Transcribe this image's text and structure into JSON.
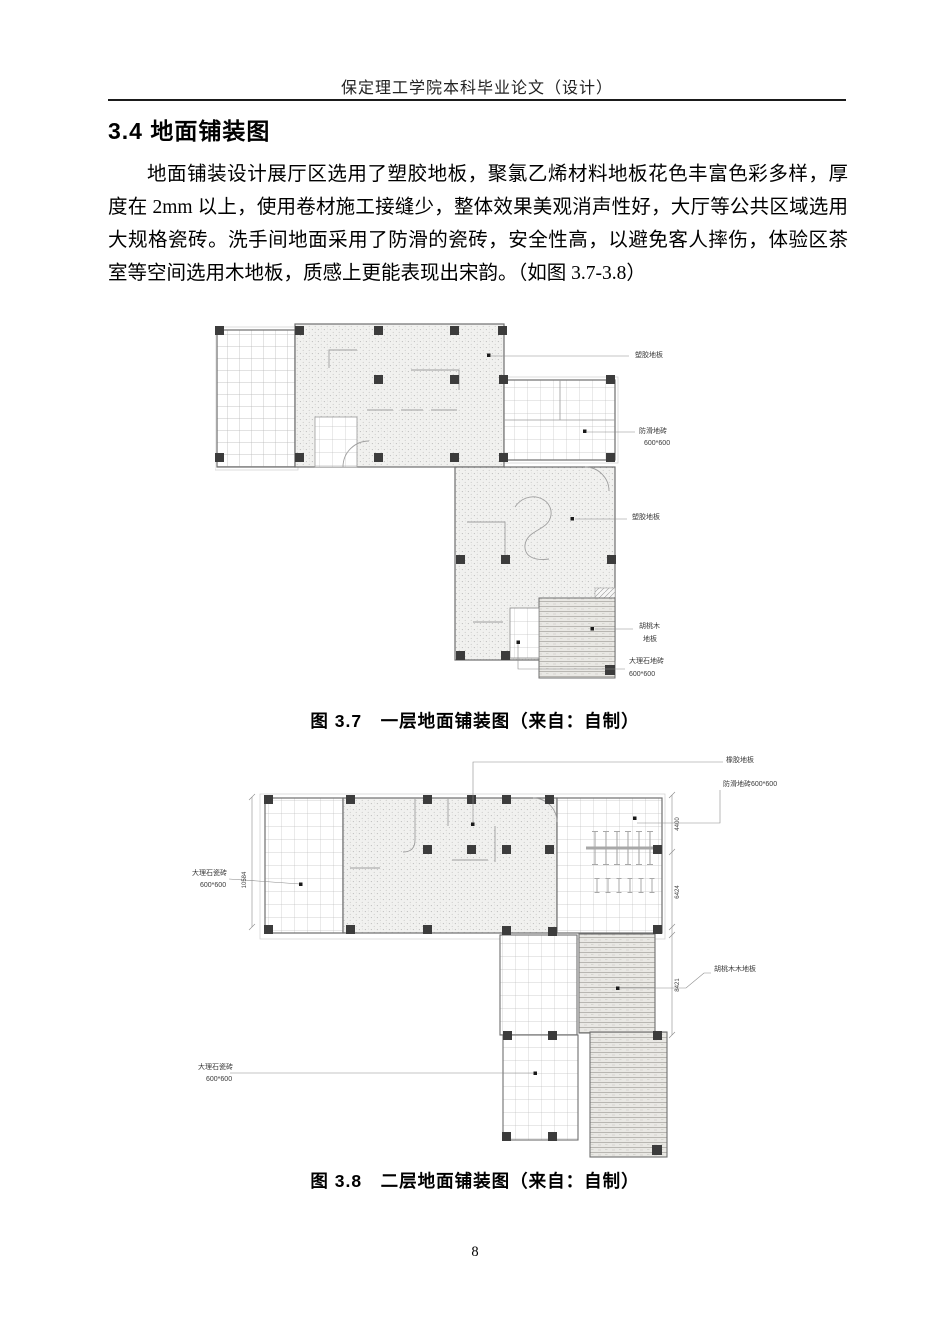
{
  "page": {
    "header": "保定理工学院本科毕业论文（设计）",
    "page_number": "8"
  },
  "section": {
    "heading": "3.4 地面铺装图",
    "paragraph": "地面铺装设计展厅区选用了塑胶地板，聚氯乙烯材料地板花色丰富色彩多样，厚度在 2mm 以上，使用卷材施工接缝少，整体效果美观消声性好，大厅等公共区域选用大规格瓷砖。洗手间地面采用了防滑的瓷砖，安全性高，以避免客人摔伤，体验区茶室等空间选用木地板，质感上更能表现出宋韵。（如图 3.7-3.8）"
  },
  "figure1": {
    "caption": "图 3.7　一层地面铺装图（来自：自制）",
    "labels": {
      "plastic_top": "塑胶地板",
      "antislip_line1": "防滑地砖",
      "antislip_line2": "600*600",
      "plastic_mid": "塑胶地板",
      "walnut_line1": "胡桃木",
      "walnut_line2": "地板",
      "marble_line1": "大理石地砖",
      "marble_line2": "600*600"
    }
  },
  "figure2": {
    "caption": "图 3.8　二层地面铺装图（来自：自制）",
    "labels": {
      "rubber": "橡胶地板",
      "antislip": "防滑地砖600*600",
      "marble_left_line1": "大理石瓷砖",
      "marble_left_line2": "600*600",
      "walnut": "胡桃木木地板",
      "marble_bottom_line1": "大理石瓷砖",
      "marble_bottom_line2": "600*600"
    },
    "dimensions": {
      "left": "10584",
      "right_top": "4400",
      "right_mid": "6424",
      "leg": "8421"
    }
  }
}
